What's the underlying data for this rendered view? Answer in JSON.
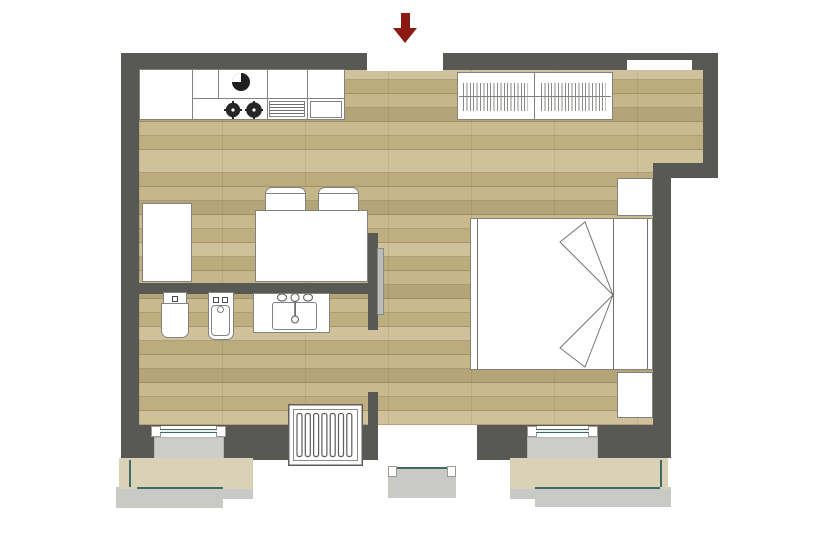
{
  "meta": {
    "kind": "apartment-floor-plan",
    "description": "Top-down studio apartment floor plan with kitchen, dining area, bathroom, sleeping area, wardrobe, radiator and two windows plus balcony door"
  },
  "colors": {
    "wall": "#585855",
    "floor_base": "#c3b184",
    "fixture_border": "#82827f",
    "sill_gray": "#cccccb",
    "terrace_beige": "#d9d2b6",
    "walkway_gray": "#c9c9c6",
    "glazing_teal": "#3f6b66",
    "arrow_red": "#8b1a12",
    "appliance_dark": "#262626",
    "door_panel": "#bcbcb9",
    "white": "#ffffff"
  },
  "rooms": [
    {
      "name": "kitchen-living-area"
    },
    {
      "name": "bathroom"
    },
    {
      "name": "sleeping-area"
    }
  ],
  "elements": [
    {
      "name": "entrance-arrow-icon",
      "meaning": "main entrance direction"
    },
    {
      "name": "entrance-opening"
    },
    {
      "name": "kitchen-counter",
      "parts": [
        "kitchen-sink-icon",
        "cooktop-burner-icon",
        "cooktop-burner-icon",
        "dishwasher-vents-icon",
        "base-unit"
      ]
    },
    {
      "name": "wardrobe",
      "parts": [
        "hanging-rail-left",
        "hanging-rail-right"
      ]
    },
    {
      "name": "tall-cabinet"
    },
    {
      "name": "dining-table"
    },
    {
      "name": "chair",
      "count": 2
    },
    {
      "name": "double-bed",
      "parts": [
        "footboard",
        "mattress",
        "duvet-fold-left",
        "duvet-fold-right",
        "headboard"
      ]
    },
    {
      "name": "nightstand",
      "count": 2
    },
    {
      "name": "toilet-icon"
    },
    {
      "name": "bidet-icon"
    },
    {
      "name": "washbasin-vanity",
      "parts": [
        "basin",
        "faucet-icon",
        "drain"
      ]
    },
    {
      "name": "radiator-icon",
      "slats": 7
    },
    {
      "name": "bathroom-door-panel"
    },
    {
      "name": "window-left"
    },
    {
      "name": "window-right"
    },
    {
      "name": "balcony-door"
    },
    {
      "name": "window-sill",
      "count": 2
    },
    {
      "name": "terrace-left"
    },
    {
      "name": "terrace-right"
    },
    {
      "name": "walkway-left"
    },
    {
      "name": "walkway-right"
    }
  ]
}
